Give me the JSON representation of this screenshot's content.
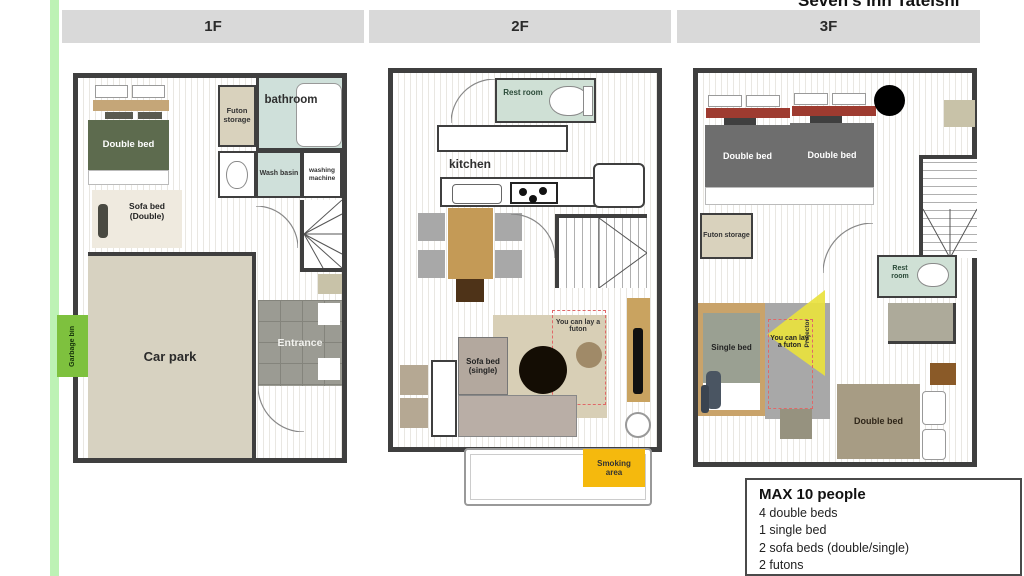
{
  "window_title": "Seven's Inn Tateishi",
  "floors": {
    "f1": {
      "header": "1F",
      "double_bed": "Double bed",
      "sofa_bed": "Sofa bed (Double)",
      "futon_storage": "Futon storage",
      "bathroom": "bathroom",
      "wash_basin": "Wash basin",
      "washing_machine": "washing machine",
      "car_park": "Car park",
      "entrance": "Entrance",
      "garbage_bin": "Garbage bin"
    },
    "f2": {
      "header": "2F",
      "rest_room": "Rest room",
      "kitchen": "kitchen",
      "sofa_bed": "Sofa bed (single)",
      "futon_note": "You can lay a futon",
      "smoking_area": "Smoking area"
    },
    "f3": {
      "header": "3F",
      "double_bed_left": "Double bed",
      "double_bed_right": "Double bed",
      "futon_storage": "Futon storage",
      "rest_room": "Rest room",
      "single_bed": "Single bed",
      "futon_note": "You can lay a futon",
      "projector": "Projector",
      "double_bed_bottom": "Double bed"
    }
  },
  "info_box": {
    "title": "MAX 10 people",
    "lines": [
      "4 double beds",
      "1 single bed",
      "2 sofa beds (double/single)",
      "2 futons"
    ]
  },
  "colors": {
    "header_gray": "#d9d9d9",
    "wall": "#3f3f3f",
    "bed_green": "#5d6b4e",
    "bed_gray": "#6e6e6e",
    "bed_brown": "#a79c84",
    "bathroom_teal": "#cfe0da",
    "restroom_green": "#cfe0d5",
    "carpark_beige": "#d7d2c1",
    "garbage_green": "#7ec13e",
    "left_stripe_green": "#bdf2b5",
    "smoking_yellow": "#f5b90d",
    "projector_yellow": "#e9e23e",
    "table_tan": "#c49a56",
    "maroon": "#9e3b30"
  }
}
